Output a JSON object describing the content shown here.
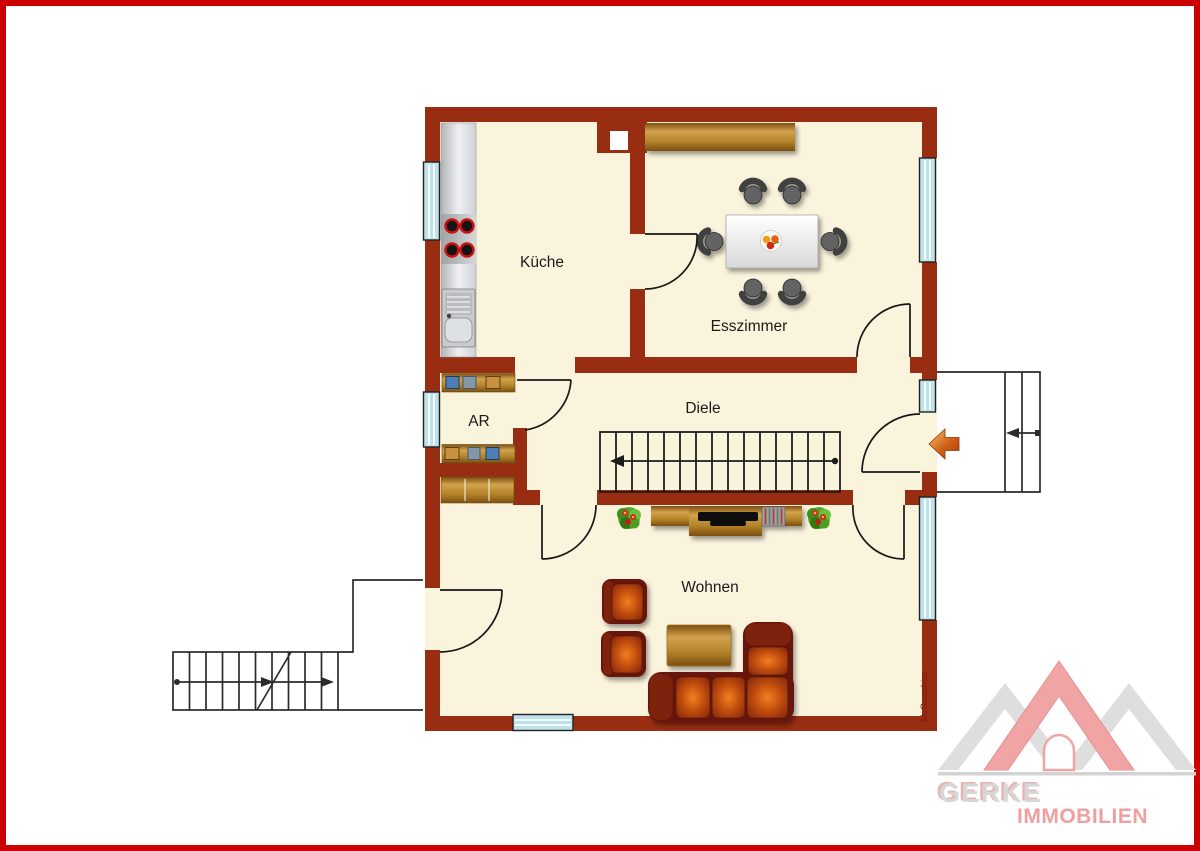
{
  "floorplan": {
    "rooms": {
      "kitchen": "Küche",
      "dining": "Esszimmer",
      "hall": "Diele",
      "storage": "AR",
      "living": "Wohnen"
    },
    "watermark": "McGrundriss",
    "colors": {
      "frame_red": "#cc0000",
      "wall": "#992d11",
      "floor": "#fbf4dd",
      "window_glass": "#bfe1e9",
      "wood": "#c89a3f",
      "sofa_leather": "#681808",
      "cushion_orange": "#c4500f",
      "entrance_arrow": "#d06018"
    }
  },
  "logo": {
    "name": "GERKE",
    "suffix": "IMMOBILIEN",
    "colors": {
      "gray": "#dedede",
      "pink": "#f0a4a4"
    }
  }
}
